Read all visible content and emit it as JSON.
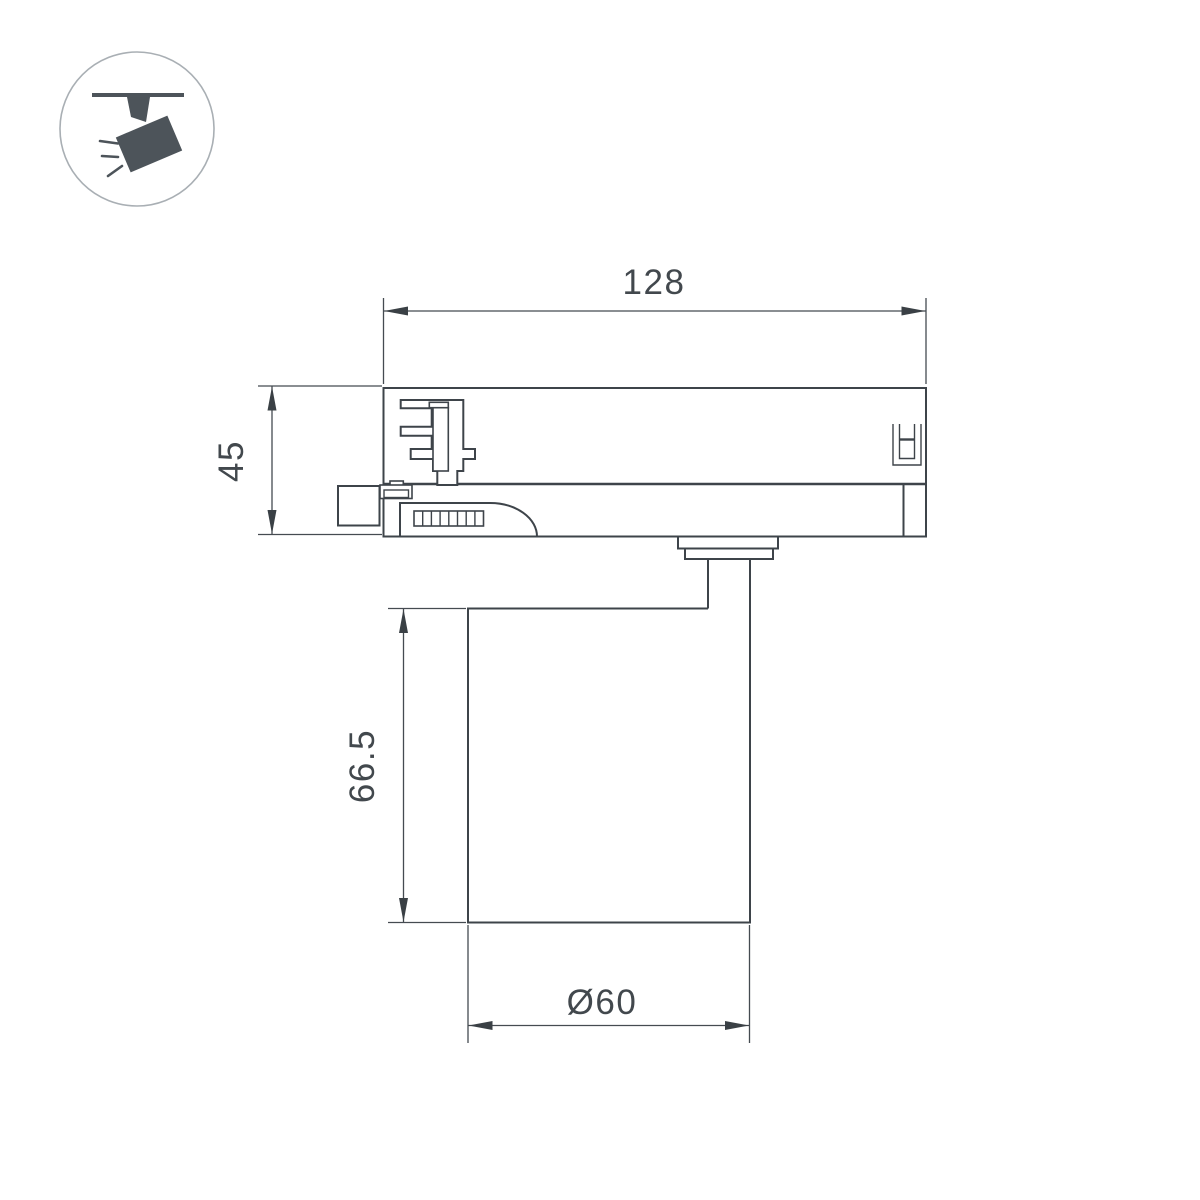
{
  "page": {
    "background_color": "#ffffff",
    "description": "Technical dimension drawing of a track-mounted spotlight luminaire"
  },
  "icon": {
    "name": "track-spotlight-pictogram",
    "fill_color": "#4d545a",
    "circle_stroke_color": "#a9afb4"
  },
  "drawing": {
    "line_color": "#3e444a",
    "text_color": "#42484d",
    "dimensions": {
      "track_adapter_width": {
        "label": "128"
      },
      "track_adapter_height": {
        "label": "45"
      },
      "lamp_body_height": {
        "label": "66.5"
      },
      "lamp_body_diameter": {
        "label": "Ø60"
      }
    }
  }
}
